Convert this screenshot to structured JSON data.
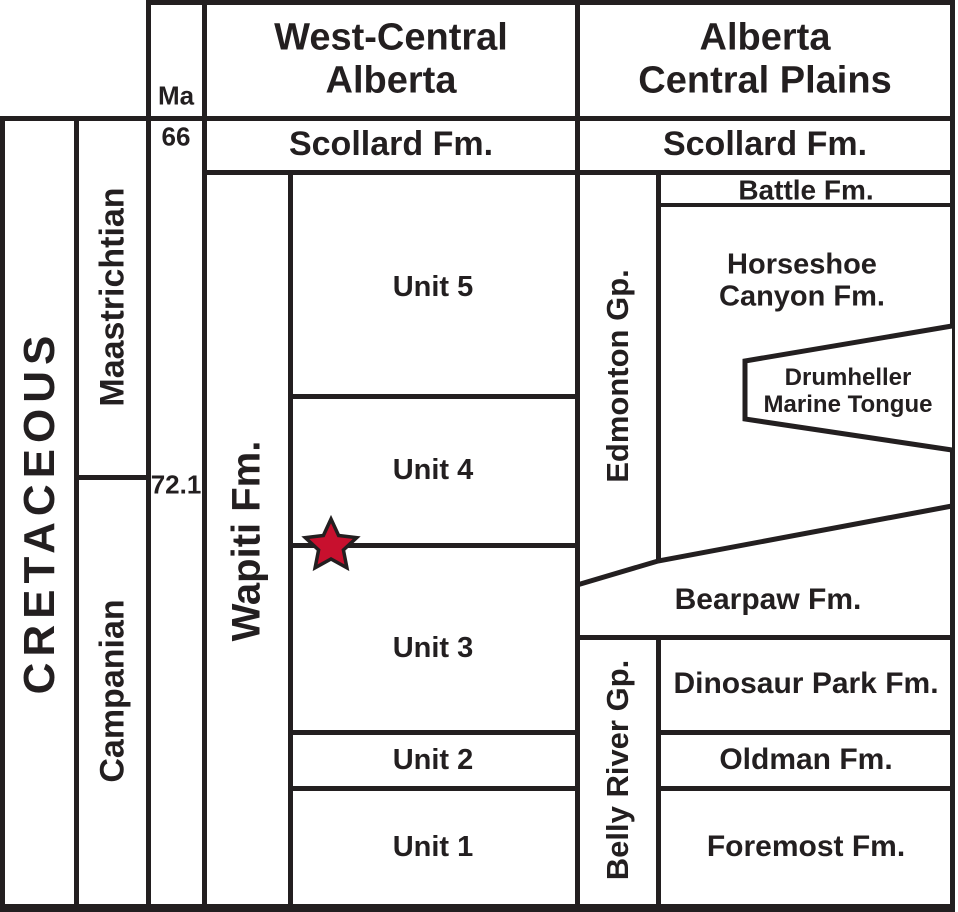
{
  "colors": {
    "background": "#ffffff",
    "ink": "#231f20",
    "star_red": "#c8102e"
  },
  "time_scale": {
    "system": "CRETACEOUS",
    "stages": [
      {
        "label": "Maastrichtian"
      },
      {
        "label": "Campanian"
      }
    ],
    "axis_label": "Ma",
    "ticks": [
      {
        "label": "66"
      },
      {
        "label": "72.1"
      }
    ]
  },
  "west_central_alberta": {
    "header": "West-Central\nAlberta",
    "scollard": "Scollard Fm.",
    "wapiti": "Wapiti Fm.",
    "units": [
      "Unit 5",
      "Unit 4",
      "Unit 3",
      "Unit 2",
      "Unit 1"
    ]
  },
  "alberta_central_plains": {
    "header": "Alberta\nCentral Plains",
    "scollard": "Scollard Fm.",
    "battle": "Battle Fm.",
    "edmonton_group": "Edmonton Gp.",
    "horseshoe_canyon": "Horseshoe\nCanyon Fm.",
    "drumheller": "Drumheller\nMarine Tongue",
    "bearpaw": "Bearpaw Fm.",
    "belly_river_group": "Belly River Gp.",
    "dinosaur_park": "Dinosaur Park Fm.",
    "oldman": "Oldman Fm.",
    "foremost": "Foremost Fm."
  },
  "marker": {
    "shape": "star",
    "color": "#c8102e"
  }
}
